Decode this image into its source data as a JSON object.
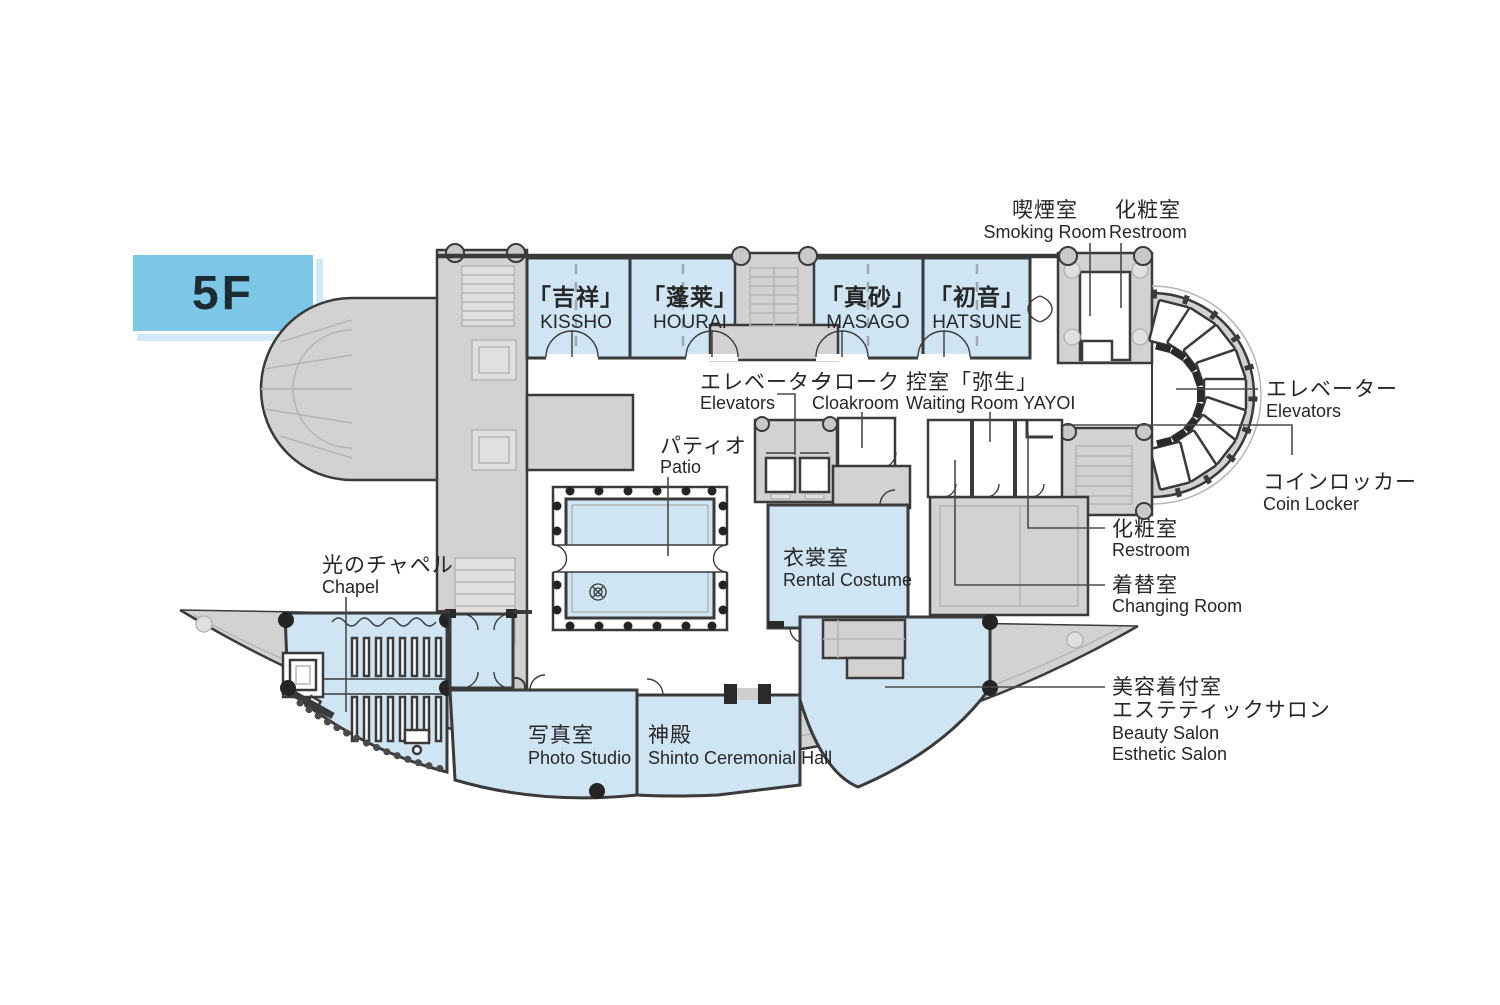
{
  "floor_badge": "5F",
  "colors": {
    "room_fill": "#cfe5f4",
    "service_fill": "#d2d2d2",
    "badge_fill": "#7cc7e8",
    "badge_shadow": "#cfe9f6",
    "wall": "#3a3a3a",
    "leader": "#4a4a4a",
    "text": "#262626"
  },
  "rooms": {
    "kissho": {
      "jp": "「吉祥」",
      "en": "KISSHO"
    },
    "hourai": {
      "jp": "「蓬莱」",
      "en": "HOURAI"
    },
    "masago": {
      "jp": "「真砂」",
      "en": "MASAGO"
    },
    "hatsune": {
      "jp": "「初音」",
      "en": "HATSUNE"
    },
    "smoking_room": {
      "jp": "喫煙室",
      "en": "Smoking Room"
    },
    "restroom_top": {
      "jp": "化粧室",
      "en": "Restroom"
    },
    "elevators_center": {
      "jp": "エレベーター",
      "en": "Elevators"
    },
    "cloakroom": {
      "jp": "クローク",
      "en": "Cloakroom"
    },
    "waiting_room_yayoi": {
      "jp": "控室「弥生」",
      "en": "Waiting Room YAYOI"
    },
    "patio": {
      "jp": "パティオ",
      "en": "Patio"
    },
    "rental_costume": {
      "jp": "衣裳室",
      "en": "Rental Costume"
    },
    "elevators_right": {
      "jp": "エレベーター",
      "en": "Elevators"
    },
    "coin_locker": {
      "jp": "コインロッカー",
      "en": "Coin Locker"
    },
    "restroom_right": {
      "jp": "化粧室",
      "en": "Restroom"
    },
    "changing_room": {
      "jp": "着替室",
      "en": "Changing Room"
    },
    "chapel": {
      "jp": "光のチャペル",
      "en": "Chapel"
    },
    "photo_studio": {
      "jp": "写真室",
      "en": "Photo Studio"
    },
    "shinto_hall": {
      "jp": "神殿",
      "en": "Shinto Ceremonial Hall"
    },
    "beauty_salon": {
      "jp1": "美容着付室",
      "jp2": "エステティックサロン",
      "en1": "Beauty Salon",
      "en2": "Esthetic Salon"
    }
  }
}
